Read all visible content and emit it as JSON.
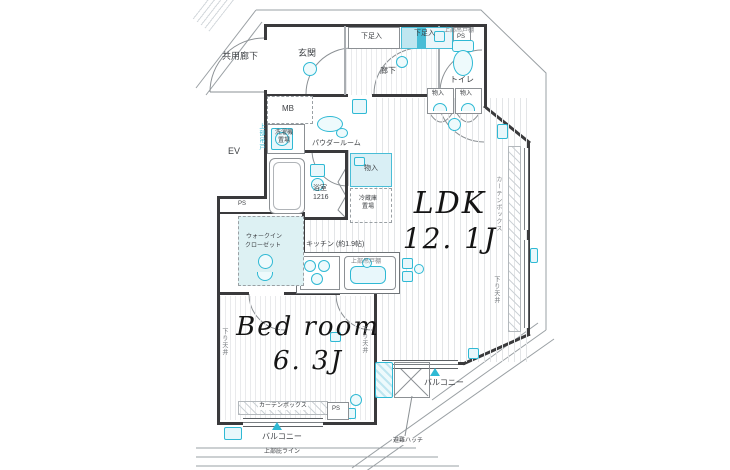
{
  "colors": {
    "accent": "#2fb9d4",
    "accent_light": "#d9eff5",
    "wall": "#3a3a3c",
    "floor_stripe": "#e3e5e7"
  },
  "rooms": {
    "ldk": {
      "name": "LDK",
      "size": "12. 1J"
    },
    "bedroom": {
      "name": "Bed room",
      "size": "6. 3J"
    },
    "kitchen": {
      "label": "キッチン (約1.9帖)"
    },
    "bath": {
      "label": "浴室",
      "size": "1216"
    },
    "powder_room": {
      "label": "パウダールーム"
    },
    "walk_in_closet": {
      "line1": "ウォークイン",
      "line2": "クローゼット"
    },
    "entrance": {
      "label": "玄関"
    },
    "hallway": {
      "label": "廊下"
    },
    "toilet": {
      "label": "トイレ"
    },
    "common_corridor": {
      "label": "共用廊下"
    }
  },
  "storage": {
    "shoe_box_1": "下足入",
    "shoe_box_2": "下足入",
    "closet_1": "物入",
    "closet_2": "物入",
    "closet_3": "物入",
    "fridge_line1": "冷蔵庫",
    "fridge_line2": "置場",
    "washer_line1": "洗濯機",
    "washer_line2": "置場",
    "upper_cabinet_washer": "上部吊戸",
    "upper_shelf_kitchen": "上部吊戸棚",
    "upper_shelf_toilet": "上部吊戸棚"
  },
  "annotations": {
    "mb": "MB",
    "ev": "EV",
    "ps_top": "PS",
    "ps_mid": "PS",
    "ps_bottom": "PS",
    "curtain_box_right": "カーテンボックス",
    "curtain_box_bottom": "カーテンボックス",
    "down_ceiling_left": "下り天井",
    "down_ceiling_right": "下り天井",
    "down_ceiling_ldk": "下り天井",
    "balcony_bottom": "バルコニー",
    "balcony_right": "バルコニー",
    "evacuation_hatch": "避難ハッチ",
    "eaves_line": "上部庇ライン"
  }
}
